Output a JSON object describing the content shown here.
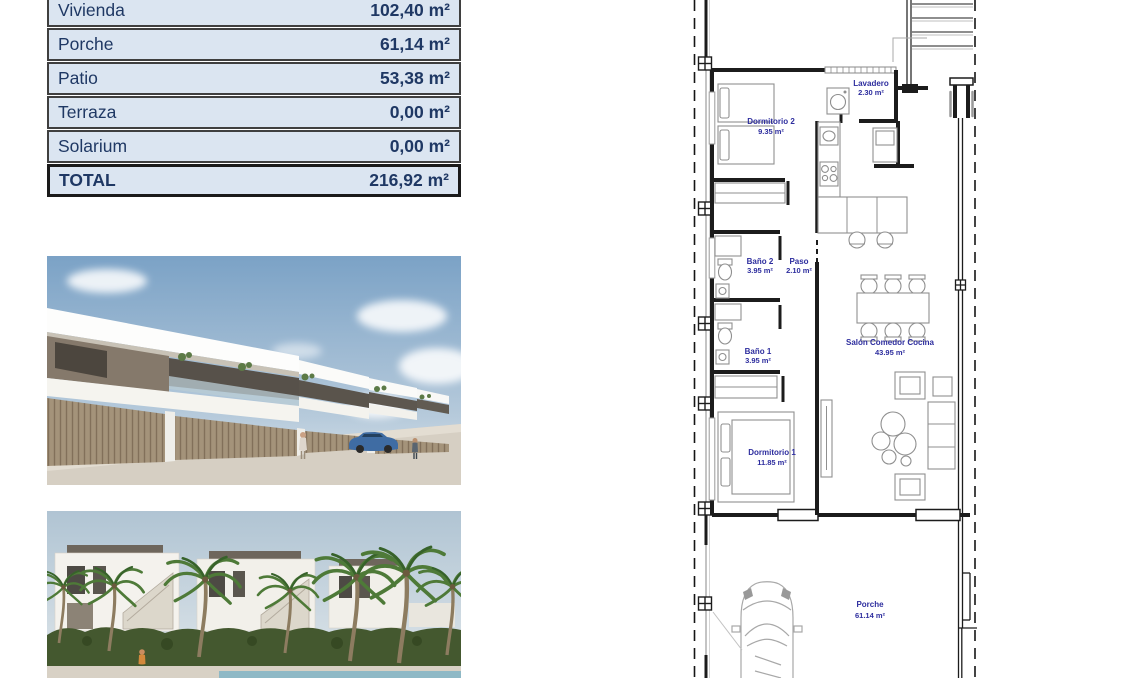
{
  "area_table": {
    "rows": [
      {
        "label": "Vivienda",
        "value": "102,40 m²"
      },
      {
        "label": "Porche",
        "value": "61,14 m²"
      },
      {
        "label": "Patio",
        "value": "53,38 m²"
      },
      {
        "label": "Terraza",
        "value": "0,00 m²"
      },
      {
        "label": "Solarium",
        "value": "0,00 m²"
      }
    ],
    "total": {
      "label": "TOTAL",
      "value": "216,92 m²"
    }
  },
  "floor_plan": {
    "rooms": [
      {
        "name": "Lavadero",
        "area": "2.30 m²"
      },
      {
        "name": "Dormitorio 2",
        "area": "9.35 m²"
      },
      {
        "name": "Baño 2",
        "area": "3.95 m²"
      },
      {
        "name": "Paso",
        "area": "2.10 m²"
      },
      {
        "name": "Baño 1",
        "area": "3.95 m²"
      },
      {
        "name": "Salón Comedor Cocina",
        "area": "43.95 m²"
      },
      {
        "name": "Dormitorio 1",
        "area": "11.85 m²"
      },
      {
        "name": "Porche",
        "area": "61.14 m²"
      }
    ]
  },
  "photos": [
    {
      "name": "street-elevation-render"
    },
    {
      "name": "garden-pool-render"
    }
  ],
  "colors": {
    "table_row_bg": "#dbe5f1",
    "table_text": "#1f3864",
    "plan_label": "#2d2d9e",
    "wall": "#1c1c1c"
  }
}
